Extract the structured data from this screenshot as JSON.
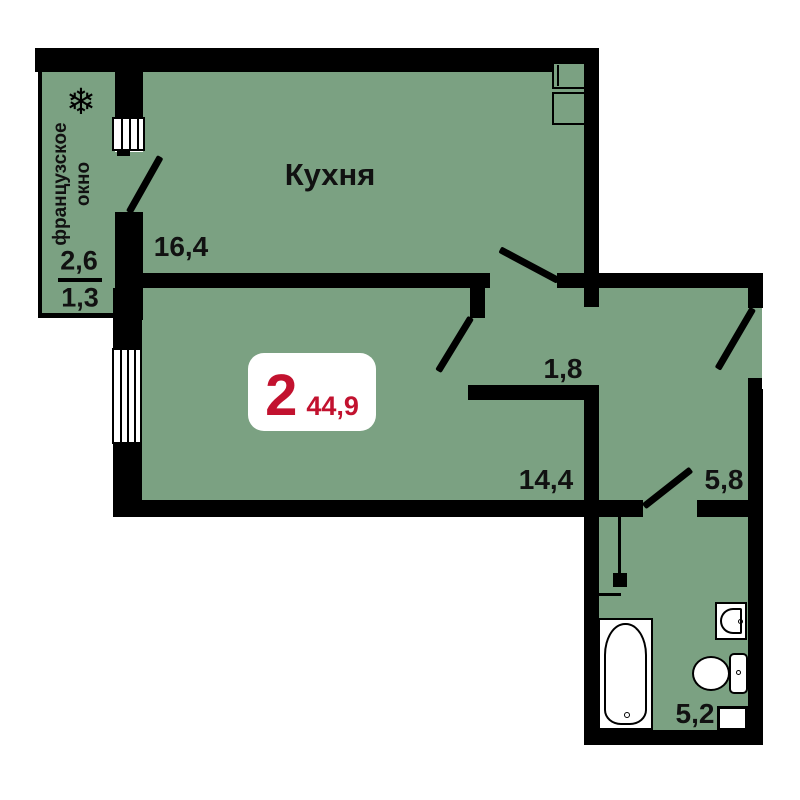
{
  "badge": {
    "rooms_count": "2",
    "total_area": "44,9"
  },
  "rooms": {
    "kitchen": {
      "name": "Кухня",
      "area": "16,4"
    },
    "hallway": {
      "area": "1,8"
    },
    "living_room": {
      "area": "14,4"
    },
    "corridor": {
      "area": "5,8"
    },
    "bathroom": {
      "area": "5,2"
    },
    "balcony": {
      "label_line1": "французское",
      "label_line2": "окно",
      "area_full": "2,6",
      "area_reduced": "1,3"
    }
  },
  "icons": {
    "snowflake": "❄"
  },
  "colors": {
    "floor": "#7ba182",
    "walls": "#000000",
    "accent": "#c2122f",
    "badge_background": "#ffffff"
  }
}
